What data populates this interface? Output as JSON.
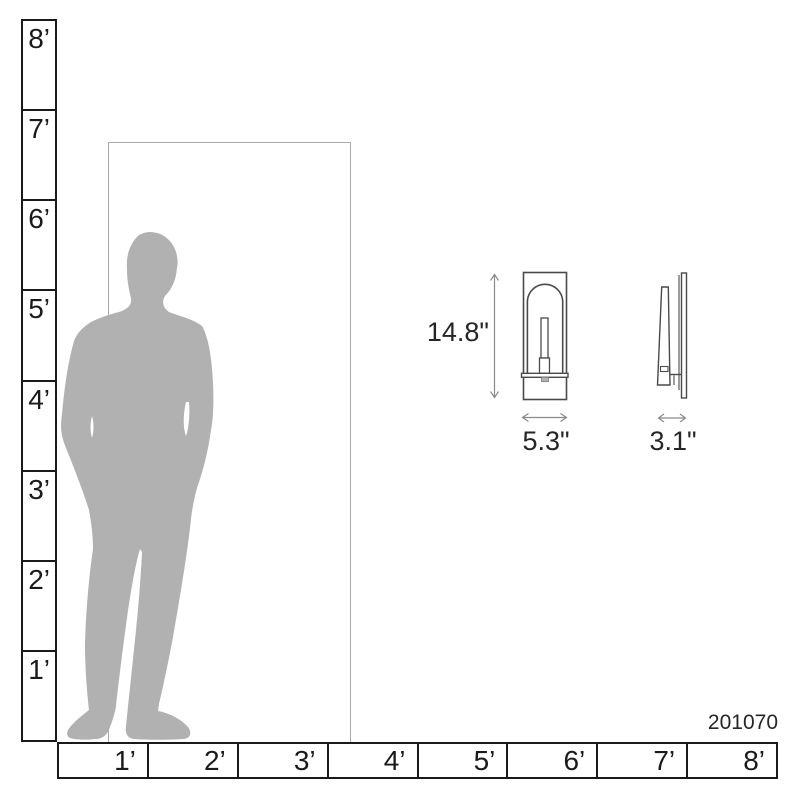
{
  "product": {
    "code": "201070",
    "height_label": "14.8\"",
    "width_label": "5.3\"",
    "depth_label": "3.1\""
  },
  "rulers": {
    "vertical_labels": [
      "8’",
      "7’",
      "6’",
      "5’",
      "4’",
      "3’",
      "2’",
      "1’"
    ],
    "horizontal_labels": [
      "1’",
      "2’",
      "3’",
      "4’",
      "5’",
      "6’",
      "7’",
      "8’"
    ]
  },
  "colors": {
    "silhouette": "#b1b1b1",
    "ruler_line": "#1a1a1a",
    "door_line": "#a9a9a9",
    "sconce_line": "#4a4a4a",
    "dimension_line": "#8a8a8a",
    "text": "#262626"
  }
}
